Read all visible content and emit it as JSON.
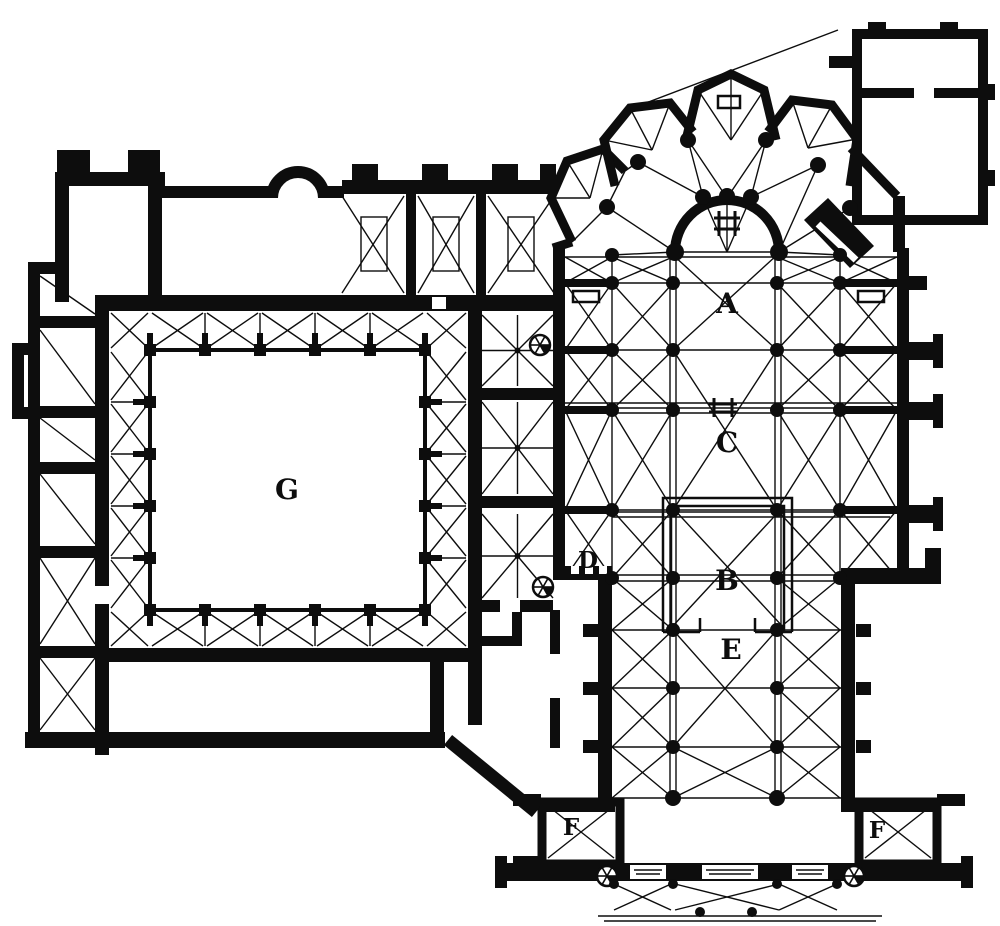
{
  "figure": {
    "type": "architectural-floor-plan",
    "subject": "Ground plan of a Gothic cathedral with adjoining cloister",
    "ink_color": "#0d0d0d",
    "background_color": "#ffffff"
  },
  "labels": {
    "A": "A",
    "B": "B",
    "C": "C",
    "D": "D",
    "E": "E",
    "F_left": "F",
    "F_right": "F",
    "G": "G"
  },
  "symbols": {
    "altar": "altar-symbol",
    "spiral_stair": "spiral-stair-symbol",
    "vault_bay": "cross-vault-bay",
    "pier": "pier-dot"
  }
}
